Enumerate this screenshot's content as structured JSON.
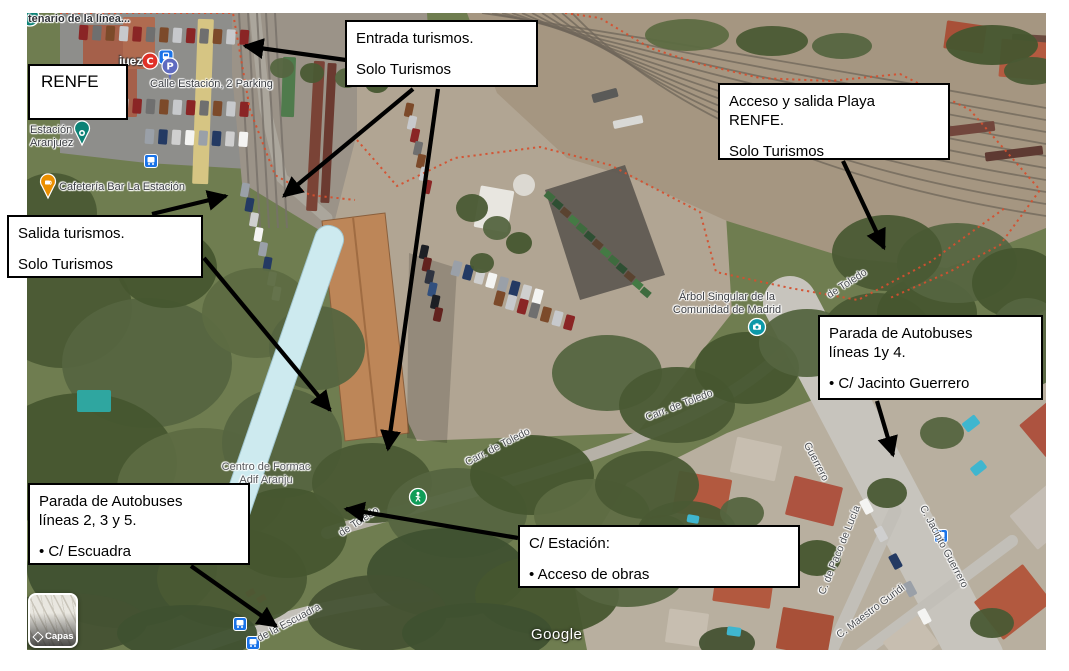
{
  "colors": {
    "arrow": "#000000",
    "strip": "#cdeaef",
    "boundary": "#d4502f",
    "callout_bg": "#ffffff",
    "callout_border": "#000000"
  },
  "callouts": {
    "renfe": {
      "lines": [
        "RENFE"
      ]
    },
    "entrada": {
      "lines": [
        "Entrada turismos.",
        "Solo Turismos"
      ]
    },
    "acceso_playa": {
      "lines": [
        "Acceso y salida Playa\nRENFE.",
        "Solo Turismos"
      ]
    },
    "salida": {
      "lines": [
        "Salida turismos.",
        "Solo Turismos"
      ]
    },
    "parada_1_4": {
      "lines": [
        "Parada de Autobuses\nlíneas 1y 4.",
        "• C/ Jacinto Guerrero"
      ]
    },
    "parada_2_3_5": {
      "lines": [
        "Parada de Autobuses\nlíneas 2, 3 y 5.",
        "• C/ Escuadra"
      ]
    },
    "estacion": {
      "lines": [
        "C/ Estación:",
        "• Acceso de obras"
      ]
    }
  },
  "map": {
    "watermark": "Google",
    "layers_label": "Capas",
    "labels": [
      {
        "name": "label-centenario",
        "text": "tenario de la línea...",
        "x": 28,
        "y": 13,
        "rot": 0,
        "cls": "strong",
        "it": true
      },
      {
        "name": "label-aranjuez",
        "text": "juez",
        "x": 119,
        "y": 55,
        "rot": 0,
        "cls": "city",
        "it": true
      },
      {
        "name": "label-calle-estacion-parking",
        "text": "Calle Estación, 2 Parking",
        "x": 150,
        "y": 78,
        "rot": 0,
        "cls": "",
        "it": true
      },
      {
        "name": "label-estacion-aranjuez",
        "text": "Estación\nAranjuez",
        "x": 30,
        "y": 124,
        "rot": 0,
        "cls": "",
        "it": true
      },
      {
        "name": "label-cafeteria-bar-la-estacion",
        "text": "Cafetería Bar La Estación",
        "x": 59,
        "y": 181,
        "rot": 0,
        "cls": "",
        "it": true
      },
      {
        "name": "label-arbol-singular",
        "text": "Árbol Singular de la\nComunidad de Madrid",
        "x": 668,
        "y": 291,
        "rot": 0,
        "cls": "center",
        "it": true,
        "w": 118
      },
      {
        "name": "label-centro-formacion-adif",
        "text": "Centro de Formac\nAdif Aranju",
        "x": 216,
        "y": 461,
        "rot": 0,
        "cls": "center dim",
        "it": true,
        "w": 100
      },
      {
        "name": "road-carr-de-toledo-1",
        "text": "Carr. de Toledo",
        "x": 466,
        "y": 457,
        "rot": -27,
        "cls": "road",
        "it": false
      },
      {
        "name": "road-carr-de-toledo-2",
        "text": "Carr. de Toledo",
        "x": 646,
        "y": 412,
        "rot": -21,
        "cls": "road",
        "it": false
      },
      {
        "name": "road-de-toledo-sw",
        "text": "de Toledo",
        "x": 340,
        "y": 528,
        "rot": -33,
        "cls": "road",
        "it": false
      },
      {
        "name": "road-de-toledo-ne",
        "text": "de Toledo",
        "x": 828,
        "y": 290,
        "rot": -33,
        "cls": "road",
        "it": false
      },
      {
        "name": "road-guerrero-upper",
        "text": "Guerrero",
        "x": 806,
        "y": 437,
        "rot": 62,
        "cls": "road",
        "it": false
      },
      {
        "name": "road-c-jacinto-guerrero",
        "text": "C. Jacinto Guerrero",
        "x": 922,
        "y": 500,
        "rot": 62,
        "cls": "road",
        "it": false
      },
      {
        "name": "road-c-de-paco-de-lucia",
        "text": "C. de Paco de Lucía",
        "x": 822,
        "y": 588,
        "rot": -68,
        "cls": "road",
        "it": false
      },
      {
        "name": "road-c-maestro-guridi",
        "text": "C. Maestro Guridi",
        "x": 838,
        "y": 630,
        "rot": -37,
        "cls": "road",
        "it": false
      },
      {
        "name": "road-de-la-escuadra",
        "text": "de la Escuadra",
        "x": 258,
        "y": 633,
        "rot": -28,
        "cls": "road",
        "it": false
      }
    ],
    "pins": [
      {
        "name": "station-area-icon",
        "type": "tealcircle",
        "x": 30,
        "y": 17
      },
      {
        "name": "cercanias-icon",
        "type": "cercanias",
        "x": 150,
        "y": 61,
        "glyph": "C"
      },
      {
        "name": "train-station-icon",
        "type": "trainsq",
        "x": 166,
        "y": 57
      },
      {
        "name": "parking-pin",
        "type": "parking",
        "x": 170,
        "y": 66,
        "glyph": "P"
      },
      {
        "name": "estacion-aranjuez-pin",
        "type": "tealdrop",
        "x": 82,
        "y": 133
      },
      {
        "name": "cafe-pin",
        "type": "cafe",
        "x": 48,
        "y": 186
      },
      {
        "name": "bus-stop-icon-1",
        "type": "bus",
        "x": 151,
        "y": 161
      },
      {
        "name": "photo-pin",
        "type": "photo",
        "x": 757,
        "y": 327
      },
      {
        "name": "pedestrian-pin",
        "type": "walk",
        "x": 418,
        "y": 497
      },
      {
        "name": "bus-stop-icon-2",
        "type": "bus",
        "x": 240,
        "y": 624
      },
      {
        "name": "bus-stop-icon-3",
        "type": "bus",
        "x": 253,
        "y": 643
      },
      {
        "name": "bus-stop-icon-4",
        "type": "bus",
        "x": 941,
        "y": 536
      }
    ],
    "arrows": [
      {
        "name": "arrow-entrada-left",
        "x1": 346,
        "y1": 60,
        "x2": 245,
        "y2": 46
      },
      {
        "name": "arrow-entrada-lot",
        "x1": 413,
        "y1": 89,
        "x2": 284,
        "y2": 196
      },
      {
        "name": "arrow-entrada-gate",
        "x1": 438,
        "y1": 89,
        "x2": 388,
        "y2": 449
      },
      {
        "name": "arrow-salida-lot",
        "x1": 152,
        "y1": 214,
        "x2": 226,
        "y2": 196
      },
      {
        "name": "arrow-salida-gate",
        "x1": 204,
        "y1": 258,
        "x2": 330,
        "y2": 410
      },
      {
        "name": "arrow-acceso-playa",
        "x1": 843,
        "y1": 161,
        "x2": 884,
        "y2": 248
      },
      {
        "name": "arrow-parada-1-4",
        "x1": 877,
        "y1": 401,
        "x2": 893,
        "y2": 455
      },
      {
        "name": "arrow-parada-2-3-5",
        "x1": 191,
        "y1": 566,
        "x2": 276,
        "y2": 626
      },
      {
        "name": "arrow-estacion",
        "x1": 518,
        "y1": 538,
        "x2": 346,
        "y2": 509
      }
    ]
  }
}
